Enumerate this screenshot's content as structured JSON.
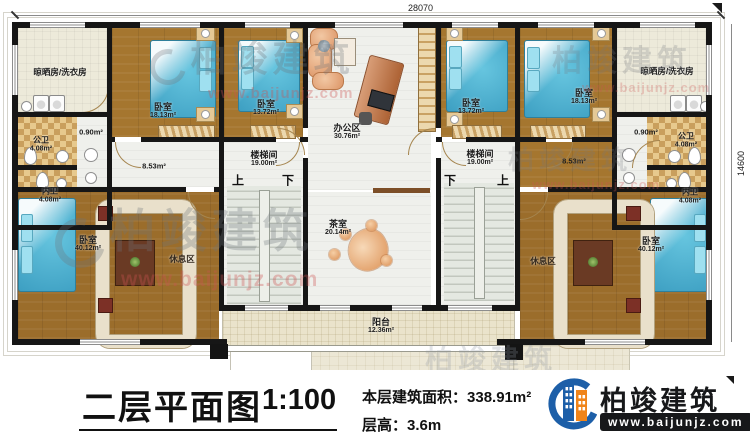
{
  "dimensions": {
    "top": "28070",
    "right": "14600"
  },
  "watermark": {
    "text": "柏竣建筑",
    "url": "www.baijunjz.com"
  },
  "stairs": {
    "up": "上",
    "down": "下"
  },
  "rooms": {
    "laundry_left": {
      "label": "晾晒房/洗衣房",
      "area": ""
    },
    "laundry_right": {
      "label": "晾晒房/洗衣房",
      "area": ""
    },
    "bedroom18_left": {
      "label": "卧室",
      "area": "18.13m²"
    },
    "bedroom13_left": {
      "label": "卧室",
      "area": "13.72m²"
    },
    "bedroom13_right": {
      "label": "卧室",
      "area": "13.72m²"
    },
    "bedroom18_right": {
      "label": "卧室",
      "area": "18.13m²"
    },
    "office": {
      "label": "办公区",
      "area": "30.76m²"
    },
    "stair_left": {
      "label": "楼梯间",
      "area": "19.00m²"
    },
    "stair_right": {
      "label": "楼梯间",
      "area": "19.00m²"
    },
    "gongwei_left": {
      "label": "公卫",
      "area": "4.08m²"
    },
    "neiwei_left": {
      "label": "内卫",
      "area": "4.08m²"
    },
    "gongwei_right": {
      "label": "公卫",
      "area": "4.08m²"
    },
    "neiwei_right": {
      "label": "内卫",
      "area": "4.08m²"
    },
    "closet_left": {
      "area": "0.90m²"
    },
    "closet_right": {
      "area": "0.90m²"
    },
    "hall_left": {
      "area": "8.53m²"
    },
    "hall_right": {
      "area": "8.53m²"
    },
    "tea": {
      "label": "茶室",
      "area": "20.14m²"
    },
    "balcony": {
      "label": "阳台",
      "area": "12.36m²"
    },
    "bedroom40_left": {
      "label": "卧室",
      "area": "40.12m²"
    },
    "bedroom40_right": {
      "label": "卧室",
      "area": "40.12m²"
    },
    "rest_left": {
      "label": "休息区"
    },
    "rest_right": {
      "label": "休息区"
    }
  },
  "footer": {
    "title": "二层平面图",
    "scale": "1:100",
    "area_label": "本层建筑面积：",
    "area_value": "338.91m²",
    "height_label": "层高：",
    "height_value": "3.6m"
  },
  "logo": {
    "name": "柏竣建筑",
    "url": "www.baijunjz.com"
  }
}
